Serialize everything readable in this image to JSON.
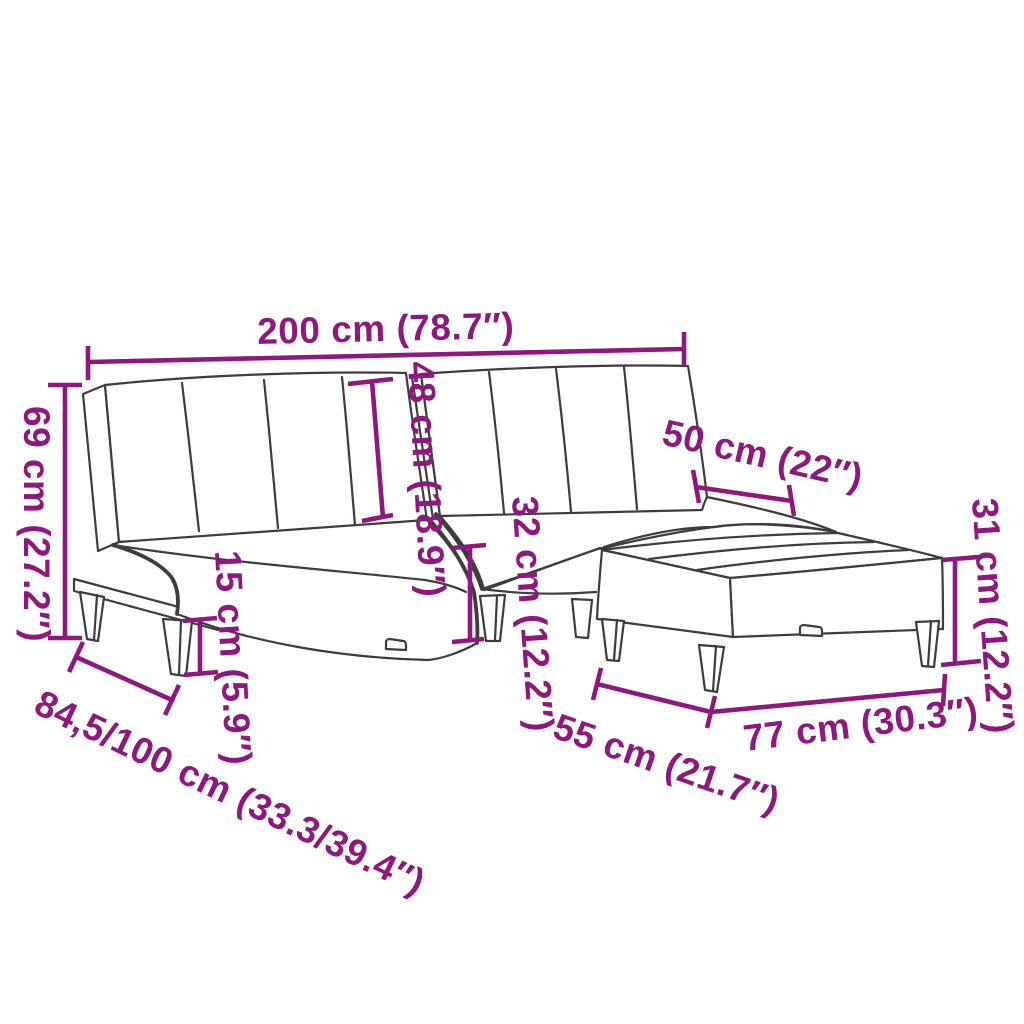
{
  "diagram": {
    "background": "#ffffff",
    "line_color": "#3d3d3d",
    "dimension_color": "#8E187E",
    "dimensions": {
      "total_width": {
        "label": "200 cm (78.7″)"
      },
      "back_height": {
        "label": "69 cm (27.2″)"
      },
      "backrest_height": {
        "label": "48 cm (18.9″)"
      },
      "seat_depth": {
        "label": "50 cm (22″)"
      },
      "seat_height": {
        "label": "32 cm (12.2″)"
      },
      "leg_height": {
        "label": "15 cm (5.9″)"
      },
      "ottoman_height": {
        "label": "31 cm (12.2″)"
      },
      "depth_range": {
        "label": "84,5/100 cm (33.3/39.4″)"
      },
      "ottoman_depth": {
        "label": "55 cm (21.7″)"
      },
      "ottoman_width": {
        "label": "77 cm (30.3″)"
      }
    }
  }
}
